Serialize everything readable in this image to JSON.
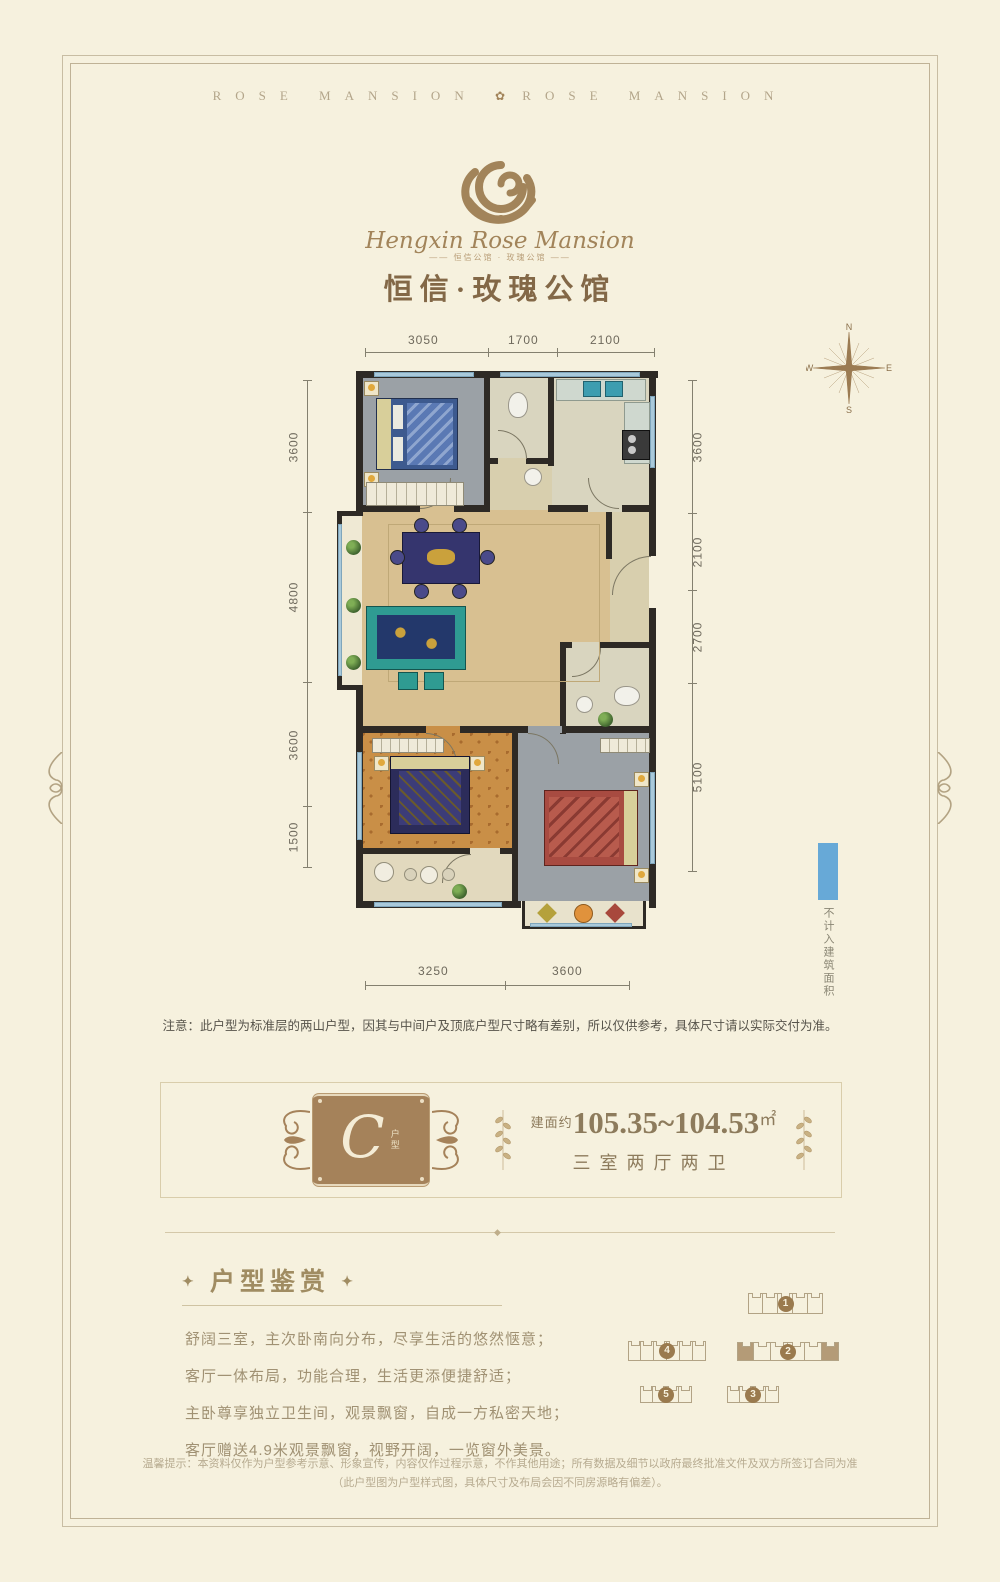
{
  "header": {
    "brand_left": "ROSE MANSION",
    "brand_right": "ROSE MANSION",
    "separator_icon": "rose-flower"
  },
  "logo": {
    "name_script": "Hengxin Rose Mansion",
    "tagline": "—— 恒信公馆 · 玫瑰公馆 ——",
    "title_cn": "恒信·玫瑰公馆"
  },
  "floorplan": {
    "dims_top": [
      "3050",
      "1700",
      "2100"
    ],
    "dims_left": [
      "3600",
      "4800",
      "3600",
      "1500"
    ],
    "dims_right": [
      "3600",
      "2100",
      "2700",
      "5100"
    ],
    "dims_bottom": [
      "3250",
      "3600"
    ],
    "compass": {
      "north": "N",
      "east": "E",
      "south": "S",
      "west": "W"
    },
    "legend": {
      "swatch_color": "#67a9d7",
      "label": "不计入建筑面积"
    },
    "note": "注意：此户型为标准层的两山户型，因其与中间户及顶底户型尺寸略有差别，所以仅供参考，具体尺寸请以实际交付为准。"
  },
  "unit_panel": {
    "unit_letter": "C",
    "unit_word": "户型",
    "area_prefix": "建面约",
    "area_value": "105.35~104.53",
    "area_unit": "㎡",
    "layout_text": "三室两厅两卫"
  },
  "appreciation": {
    "star": "✦",
    "title": "户型鉴赏",
    "lines": [
      "舒阔三室，主次卧南向分布，尽享生活的悠然惬意；",
      "客厅一体布局，功能合理，生活更添便捷舒适；",
      "主卧尊享独立卫生间，观景飘窗，自成一方私密天地；",
      "客厅赠送4.9米观景飘窗，视野开阔，一览窗外美景。"
    ]
  },
  "siteplan": {
    "buildings": [
      {
        "label": "1"
      },
      {
        "label": "2"
      },
      {
        "label": "3"
      },
      {
        "label": "4"
      },
      {
        "label": "5"
      }
    ]
  },
  "disclaimer": {
    "line1": "温馨提示：本资料仅作为户型参考示意、形象宣传，内容仅作过程示意，不作其他用途；所有数据及细节以政府最终批准文件及双方所签订合同为准",
    "line2": "（此户型图为户型样式图，具体尺寸及布局会因不同房源略有偏差）。"
  }
}
